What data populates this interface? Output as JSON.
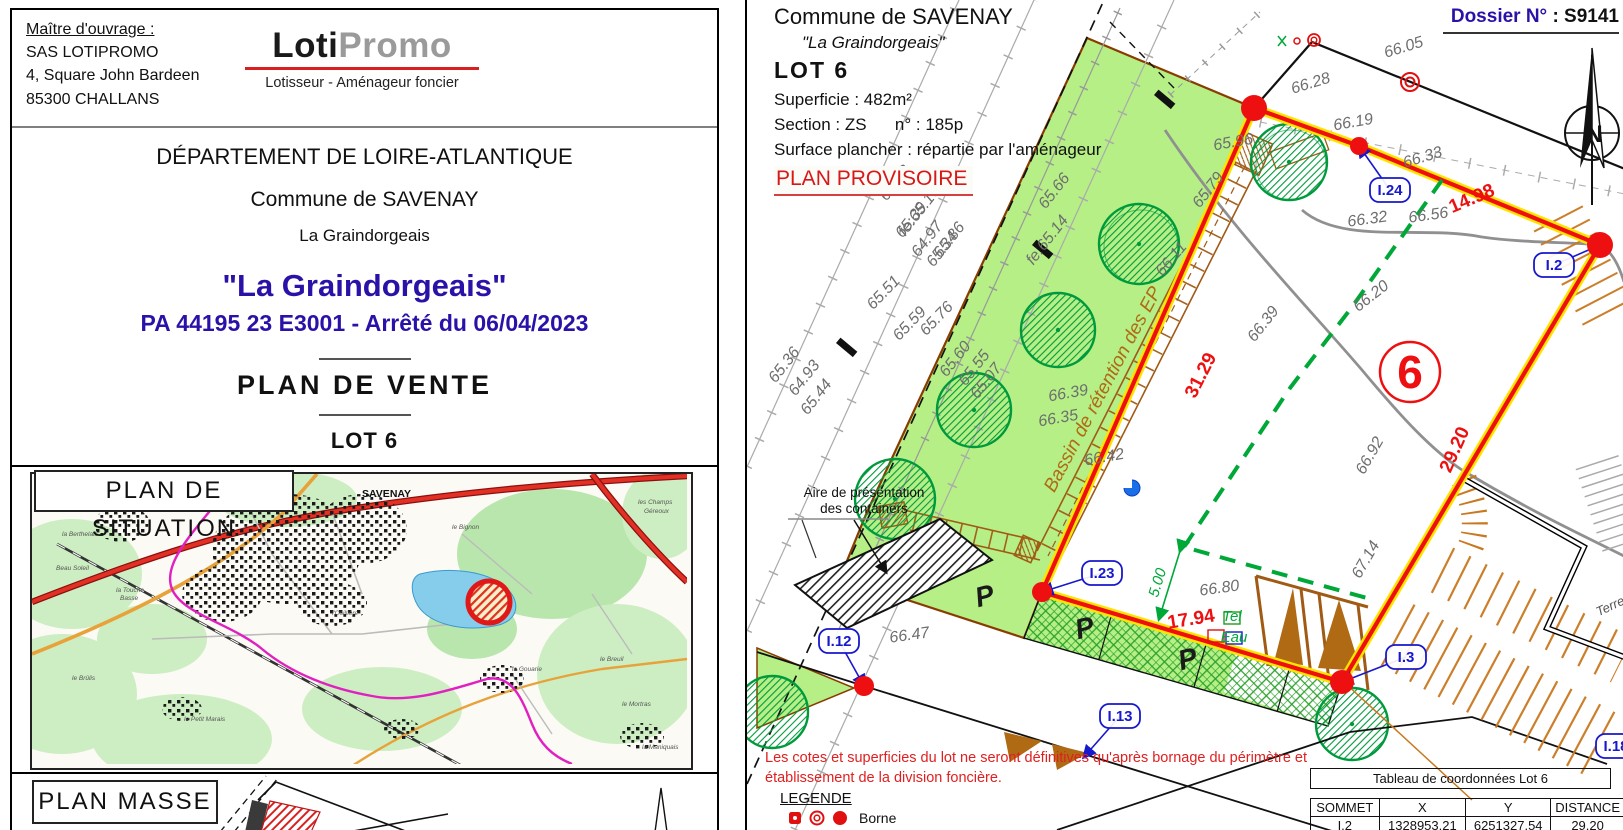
{
  "left_panel": {
    "header": {
      "client_label": "Maître d'ouvrage :",
      "client_name": "SAS LOTIPROMO",
      "client_address1": "4, Square John Bardeen",
      "client_address2": "85300 CHALLANS",
      "logo_part1": "Loti",
      "logo_part2": "Promo",
      "logo_subtitle": "Lotisseur - Aménageur foncier"
    },
    "title_block": {
      "department": "DÉPARTEMENT DE LOIRE-ATLANTIQUE",
      "commune": "Commune de SAVENAY",
      "place": "La Graindorgeais",
      "project_title": "\"La Graindorgeais\"",
      "permit": "PA 44195 23 E3001 - Arrêté du 06/04/2023",
      "doc_type": "PLAN  DE  VENTE",
      "lot": "LOT 6"
    },
    "situation": {
      "title": "PLAN  DE  SITUATION",
      "labels": [
        {
          "t": "SAVENAY",
          "x": 330,
          "y": 23,
          "b": 1
        },
        {
          "t": "la Touche",
          "x": 84,
          "y": 118
        },
        {
          "t": "Basse",
          "x": 88,
          "y": 126
        },
        {
          "t": "l'Osillière",
          "x": 300,
          "y": 141
        },
        {
          "t": "le Petit Marais",
          "x": 152,
          "y": 247
        },
        {
          "t": "la Gouarie",
          "x": 480,
          "y": 197
        },
        {
          "t": "le Breuil",
          "x": 568,
          "y": 187
        },
        {
          "t": "les Champs",
          "x": 606,
          "y": 30
        },
        {
          "t": "Géreoux",
          "x": 612,
          "y": 39
        },
        {
          "t": "le Brûlis",
          "x": 40,
          "y": 206
        },
        {
          "t": "Beau Soleil",
          "x": 24,
          "y": 96
        },
        {
          "t": "la Berthelais",
          "x": 30,
          "y": 62
        },
        {
          "t": "le Bignon",
          "x": 420,
          "y": 55
        },
        {
          "t": "la Maniquais",
          "x": 610,
          "y": 275
        },
        {
          "t": "le Mortras",
          "x": 590,
          "y": 232
        }
      ]
    },
    "masse": {
      "title": "PLAN  MASSE"
    }
  },
  "right_panel": {
    "header": {
      "commune": "Commune de SAVENAY",
      "place": "\"La Graindorgeais\"",
      "lot": "LOT 6",
      "superficie": "Superficie :  482m²",
      "section": "Section : ZS      n° : 185p",
      "surface": "Surface plancher : répartie par l'aménageur",
      "provisional": "PLAN PROVISOIRE",
      "dossier_label": "Dossier N°",
      "dossier_value": " : S9141"
    },
    "plan": {
      "lot_number": "6",
      "labels": [
        {
          "t": "65.62",
          "x": 897,
          "y": 186,
          "r": -52,
          "c": "elev"
        },
        {
          "t": "fe:65.16",
          "x": 921,
          "y": 214,
          "r": -52,
          "c": "elev"
        },
        {
          "t": "65.86",
          "x": 951,
          "y": 243,
          "r": -52,
          "c": "elev"
        },
        {
          "t": "66.28",
          "x": 1310,
          "y": 88,
          "r": -17,
          "c": "elev"
        },
        {
          "t": "66.05",
          "x": 1403,
          "y": 52,
          "r": -17,
          "c": "elev"
        },
        {
          "t": "65.96",
          "x": 1232,
          "y": 147,
          "r": -10,
          "c": "elev"
        },
        {
          "t": "66.19",
          "x": 1352,
          "y": 127,
          "r": -10,
          "c": "elev"
        },
        {
          "t": "66.33",
          "x": 1422,
          "y": 162,
          "r": -17,
          "c": "elev"
        },
        {
          "t": "66.32",
          "x": 1366,
          "y": 224,
          "r": -8,
          "c": "elev"
        },
        {
          "t": "66.56",
          "x": 1427,
          "y": 220,
          "r": -8,
          "c": "elev"
        },
        {
          "t": "66.20",
          "x": 1372,
          "y": 300,
          "r": -38,
          "c": "elev"
        },
        {
          "t": "65.66",
          "x": 1056,
          "y": 194,
          "r": -52,
          "c": "elev"
        },
        {
          "t": "fe.65.14",
          "x": 1049,
          "y": 243,
          "r": -52,
          "c": "elev"
        },
        {
          "t": "65.79",
          "x": 1210,
          "y": 193,
          "r": -52,
          "c": "elev"
        },
        {
          "t": "66.11",
          "x": 1173,
          "y": 262,
          "r": -50,
          "c": "elev"
        },
        {
          "t": "65.39",
          "x": 913,
          "y": 223,
          "r": -52,
          "c": "elev"
        },
        {
          "t": "64.97",
          "x": 929,
          "y": 242,
          "r": -52,
          "c": "elev"
        },
        {
          "t": "65.34",
          "x": 944,
          "y": 252,
          "r": -52,
          "c": "elev"
        },
        {
          "t": "65.51",
          "x": 885,
          "y": 296,
          "r": -46,
          "c": "elev"
        },
        {
          "t": "65.59",
          "x": 911,
          "y": 327,
          "r": -46,
          "c": "elev"
        },
        {
          "t": "65.76",
          "x": 938,
          "y": 322,
          "r": -46,
          "c": "elev"
        },
        {
          "t": "65.36",
          "x": 786,
          "y": 368,
          "r": -52,
          "c": "elev"
        },
        {
          "t": "64.93",
          "x": 806,
          "y": 381,
          "r": -52,
          "c": "elev"
        },
        {
          "t": "65.44",
          "x": 818,
          "y": 400,
          "r": -52,
          "c": "elev"
        },
        {
          "t": "65.60",
          "x": 957,
          "y": 362,
          "r": -52,
          "c": "elev"
        },
        {
          "t": "65.55",
          "x": 976,
          "y": 371,
          "r": -52,
          "c": "elev"
        },
        {
          "t": "65.07",
          "x": 988,
          "y": 384,
          "r": -52,
          "c": "elev"
        },
        {
          "t": "66.39",
          "x": 1067,
          "y": 398,
          "r": -10,
          "c": "elev"
        },
        {
          "t": "66.35",
          "x": 1057,
          "y": 423,
          "r": -10,
          "c": "elev"
        },
        {
          "t": "66.42",
          "x": 1103,
          "y": 462,
          "r": -10,
          "c": "elev"
        },
        {
          "t": "66.39",
          "x": 1265,
          "y": 327,
          "r": -52,
          "c": "elev"
        },
        {
          "t": "66.92",
          "x": 1372,
          "y": 458,
          "r": -60,
          "c": "elev"
        },
        {
          "t": "67.14",
          "x": 1368,
          "y": 562,
          "r": -60,
          "c": "elev"
        },
        {
          "t": "66.80",
          "x": 1218,
          "y": 593,
          "r": -8,
          "c": "elev"
        },
        {
          "t": "66.47",
          "x": 908,
          "y": 640,
          "r": -8,
          "c": "elev"
        },
        {
          "t": "14.98",
          "x": 1472,
          "y": 204,
          "r": -23,
          "c": "rdim"
        },
        {
          "t": "31.29",
          "x": 1204,
          "y": 378,
          "r": -63,
          "c": "rdim"
        },
        {
          "t": "29.20",
          "x": 1458,
          "y": 452,
          "r": -66,
          "c": "rdim"
        },
        {
          "t": "17.94",
          "x": 1190,
          "y": 625,
          "r": -9,
          "c": "rdim"
        },
        {
          "t": "5.00",
          "x": 1160,
          "y": 584,
          "r": -73,
          "c": "gdim"
        },
        {
          "t": "Bassin de rétention des EP",
          "x": 1106,
          "y": 392,
          "r": -62,
          "c": "bassin"
        },
        {
          "t": "P",
          "x": 985,
          "y": 605,
          "r": -15,
          "c": "pletter"
        },
        {
          "t": "P",
          "x": 1085,
          "y": 637,
          "r": -15,
          "c": "pletter"
        },
        {
          "t": "P",
          "x": 1188,
          "y": 668,
          "r": -15,
          "c": "pletter"
        },
        {
          "t": "Aire de présentation",
          "x": 862,
          "y": 497,
          "r": 0,
          "c": "cont"
        },
        {
          "t": "des containers",
          "x": 862,
          "y": 513,
          "r": 0,
          "c": "cont"
        },
        {
          "t": "Terre",
          "x": 1610,
          "y": 610,
          "r": -25,
          "c": "terre"
        },
        {
          "t": "Tel",
          "x": 1230,
          "y": 621,
          "r": 0,
          "c": "gdim"
        },
        {
          "t": "Eau",
          "x": 1232,
          "y": 642,
          "r": 0,
          "c": "gdim"
        }
      ],
      "points": [
        {
          "id": "I.24",
          "bx": 1368,
          "by": 178,
          "dx": 1357,
          "dy": 146,
          "r": 9
        },
        {
          "id": "I.2",
          "bx": 1532,
          "by": 253,
          "dx": 1598,
          "dy": 245,
          "r": 13
        },
        {
          "id": "I.23",
          "bx": 1080,
          "by": 561,
          "dx": 1040,
          "dy": 592,
          "r": 10
        },
        {
          "id": "I.12",
          "bx": 817,
          "by": 629,
          "dx": 862,
          "dy": 686,
          "r": 10
        },
        {
          "id": "I.13",
          "bx": 1098,
          "by": 704,
          "dx": 1082,
          "dy": 757,
          "r": 0
        },
        {
          "id": "I.3",
          "bx": 1384,
          "by": 645,
          "dx": 1340,
          "dy": 682,
          "r": 12
        },
        {
          "id": "I.18",
          "bx": 1594,
          "by": 734,
          "r": 0
        }
      ]
    },
    "notes": {
      "disclaimer1": "Les cotes et superficies du lot ne seront définitives qu'après bornage du périmètre et",
      "disclaimer2": "établissement de la division foncière.",
      "legend_title": "LEGENDE",
      "legend_borne": "Borne"
    },
    "table": {
      "title": "Tableau de coordonnées Lot 6",
      "headers": [
        "SOMMET",
        "X",
        "Y",
        "DISTANCE"
      ],
      "rows": [
        [
          "I.2",
          "1328953.21",
          "6251327.54",
          "29.20"
        ]
      ]
    }
  },
  "colors": {
    "accent_red": "#ee1010",
    "boundary_yellow": "#ffe400",
    "navy": "#2a12a8",
    "strip_green": "#b5ef86",
    "brown": "#a05a14",
    "blue_label": "#1818cc",
    "dash_green": "#00a838"
  }
}
